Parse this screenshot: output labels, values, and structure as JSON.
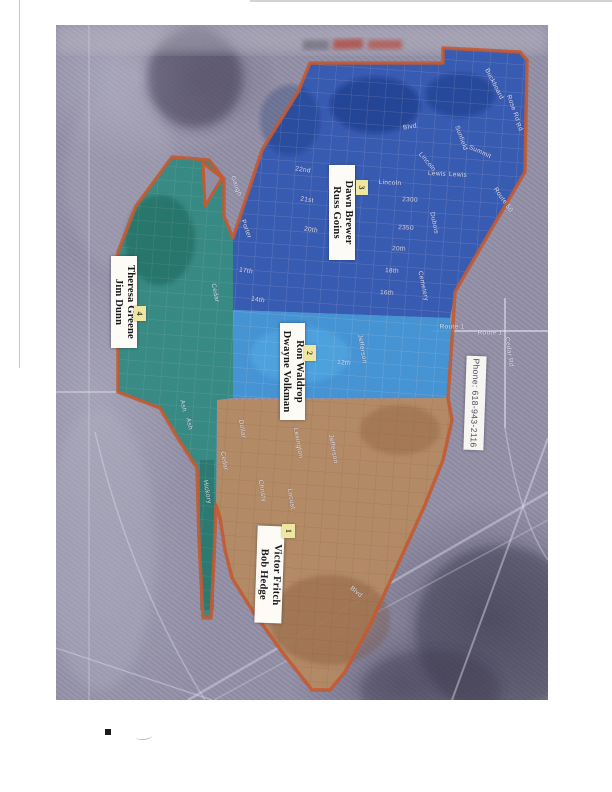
{
  "map": {
    "boundary_color": "#c35a32",
    "photo_base_color": "#928fa6",
    "zones": [
      {
        "number": "1",
        "names": [
          "Victor Fritch",
          "Bob Hedge"
        ],
        "color": "#b6895f"
      },
      {
        "number": "2",
        "names": [
          "Ron Waldrop",
          "Dwayne Volkman"
        ],
        "color": "#3d93d8"
      },
      {
        "number": "3",
        "names": [
          "Dawn Brewer",
          "Russ Goins"
        ],
        "color": "#2f55b4"
      },
      {
        "number": "4",
        "names": [
          "Theresa Greene",
          "Jim Dunn"
        ],
        "color": "#2d8a7f"
      }
    ],
    "phone_label": "Phone: 618-943-2116",
    "streets": [
      {
        "text": "Gaugh",
        "x": 236,
        "y": 186,
        "rot": 70
      },
      {
        "text": "22nd",
        "x": 303,
        "y": 170,
        "rot": 8
      },
      {
        "text": "21st",
        "x": 307,
        "y": 200,
        "rot": 8
      },
      {
        "text": "20th",
        "x": 311,
        "y": 230,
        "rot": 8
      },
      {
        "text": "Porter",
        "x": 246,
        "y": 229,
        "rot": 70
      },
      {
        "text": "17th",
        "x": 246,
        "y": 271,
        "rot": 8
      },
      {
        "text": "Cedar",
        "x": 215,
        "y": 293,
        "rot": 78
      },
      {
        "text": "14th",
        "x": 258,
        "y": 300,
        "rot": 8
      },
      {
        "text": "Blvd",
        "x": 410,
        "y": 127,
        "rot": -10
      },
      {
        "text": "Lincoln",
        "x": 390,
        "y": 183,
        "rot": 3
      },
      {
        "text": "Lincoln",
        "x": 427,
        "y": 162,
        "rot": 50
      },
      {
        "text": "Lewis",
        "x": 437,
        "y": 174,
        "rot": 3
      },
      {
        "text": "Lewis",
        "x": 458,
        "y": 175,
        "rot": 3
      },
      {
        "text": "2300",
        "x": 410,
        "y": 200,
        "rot": 3
      },
      {
        "text": "2350",
        "x": 406,
        "y": 228,
        "rot": 3
      },
      {
        "text": "20th",
        "x": 399,
        "y": 249,
        "rot": 3
      },
      {
        "text": "18th",
        "x": 392,
        "y": 271,
        "rot": 3
      },
      {
        "text": "16th",
        "x": 387,
        "y": 293,
        "rot": 3
      },
      {
        "text": "Cemetery",
        "x": 423,
        "y": 286,
        "rot": 78
      },
      {
        "text": "Dubois",
        "x": 434,
        "y": 223,
        "rot": 78
      },
      {
        "text": "Summit",
        "x": 480,
        "y": 152,
        "rot": 25
      },
      {
        "text": "Route 50",
        "x": 503,
        "y": 200,
        "rot": 55
      },
      {
        "text": "Rd",
        "x": 519,
        "y": 127,
        "rot": 60
      },
      {
        "text": "Buckboard",
        "x": 494,
        "y": 84,
        "rot": 63
      },
      {
        "text": "Rose Rd",
        "x": 513,
        "y": 108,
        "rot": 70
      },
      {
        "text": "Sunfield",
        "x": 461,
        "y": 138,
        "rot": 70
      },
      {
        "text": "Ash",
        "x": 183,
        "y": 406,
        "rot": 78
      },
      {
        "text": "Ash",
        "x": 189,
        "y": 424,
        "rot": 78
      },
      {
        "text": "Jefferson",
        "x": 362,
        "y": 349,
        "rot": 80
      },
      {
        "text": "12th",
        "x": 344,
        "y": 363,
        "rot": 5
      },
      {
        "text": "Route 1",
        "x": 452,
        "y": 327,
        "rot": 0
      },
      {
        "text": "Route 1",
        "x": 490,
        "y": 333,
        "rot": 0
      },
      {
        "text": "Cedar Rd",
        "x": 509,
        "y": 352,
        "rot": 82
      },
      {
        "text": "Lexington",
        "x": 298,
        "y": 443,
        "rot": 80
      },
      {
        "text": "Cedar",
        "x": 224,
        "y": 461,
        "rot": 80
      },
      {
        "text": "Hickory",
        "x": 207,
        "y": 492,
        "rot": 80
      },
      {
        "text": "Dollar",
        "x": 242,
        "y": 429,
        "rot": 80
      },
      {
        "text": "Christy",
        "x": 262,
        "y": 491,
        "rot": 80
      },
      {
        "text": "Locust",
        "x": 291,
        "y": 499,
        "rot": 80
      },
      {
        "text": "Jefferson",
        "x": 333,
        "y": 449,
        "rot": 80
      },
      {
        "text": "Blvd",
        "x": 356,
        "y": 592,
        "rot": 40
      }
    ]
  }
}
